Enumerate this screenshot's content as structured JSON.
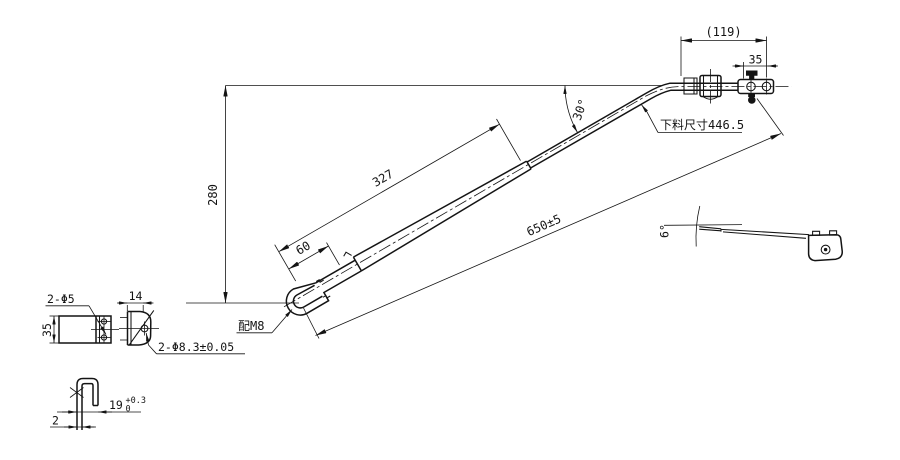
{
  "meta": {
    "background": "#ffffff",
    "ink": "#141414",
    "drawing_type": "wiper-arm engineering drawing"
  },
  "main_view": {
    "labels": {
      "dim_height": "280",
      "dim_arm": "327",
      "dim_hook": "60",
      "dim_overall": "650±5",
      "angle": "30°",
      "dim_head_offset": "(119)",
      "dim_head_hole": "35",
      "note_blank": "下料尺寸446.5",
      "note_fit": "配M8"
    }
  },
  "detail_views": {
    "bracket_side": {
      "dim_height": "35",
      "note_holes": "2-Φ5"
    },
    "bracket_front": {
      "dim_width": "14",
      "note_holes": "2-Φ8.3±0.05"
    },
    "hook_section": {
      "dim_width": "19",
      "tol_upper": "+0.3",
      "tol_lower": "0",
      "dim_thickness": "2"
    }
  },
  "side_view": {
    "angle": "6°"
  }
}
